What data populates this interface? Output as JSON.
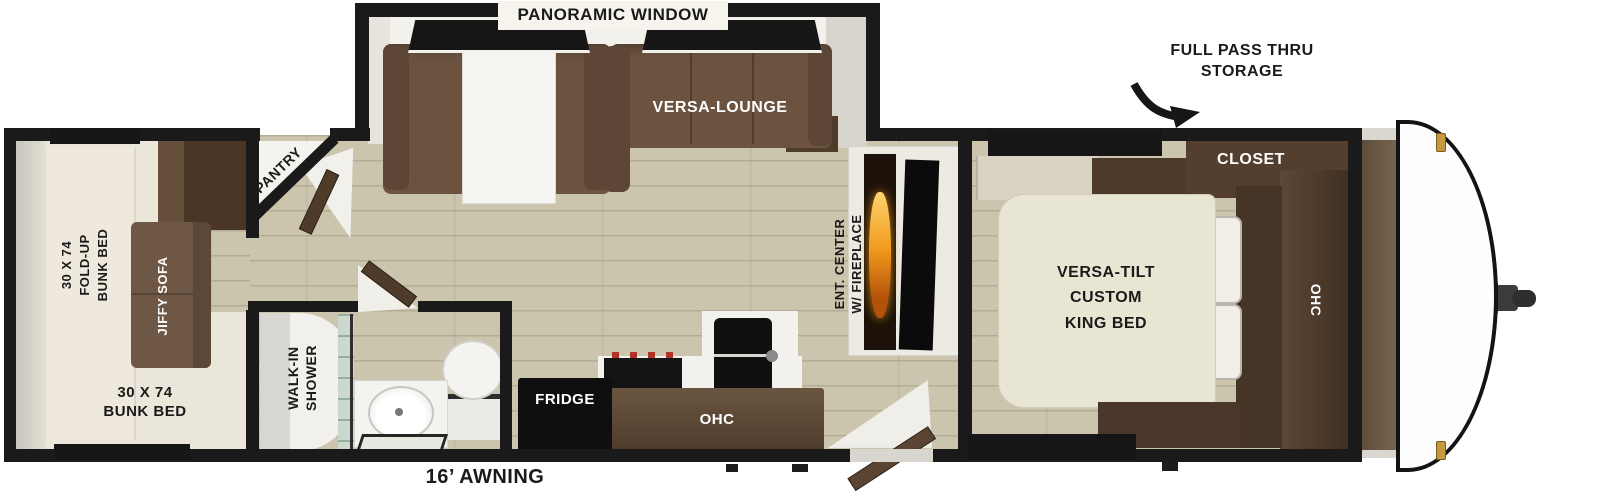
{
  "floorplan": {
    "slideout": {
      "window_label": "PANORAMIC WINDOW",
      "lounge_label": "VERSA-LOUNGE"
    },
    "bunk_room": {
      "foldup_bunk_label": "30 X 74\nFOLD-UP\nBUNK BED",
      "jiffy_sofa_label": "JIFFY SOFA",
      "bunk_bed_label": "30 X 74\nBUNK BED"
    },
    "pantry": {
      "label": "PANTRY"
    },
    "bathroom": {
      "shower_label": "WALK-IN\nSHOWER"
    },
    "kitchen": {
      "fridge_label": "FRIDGE",
      "ohc_label": "OHC"
    },
    "living": {
      "ent_center_label": "ENT. CENTER\nW/ FIREPLACE"
    },
    "bedroom": {
      "bed_label": "VERSA-TILT\nCUSTOM\nKING BED",
      "closet_label": "CLOSET",
      "ohc_label": "OHC"
    },
    "exterior": {
      "storage_label": "FULL PASS THRU\nSTORAGE",
      "awning_label": "16’ AWNING"
    }
  },
  "palette": {
    "wall": "#1a1a1a",
    "floor_wood": "#cbc5ae",
    "bunk_room_floor": "#eae6d9",
    "sofa_brown": "#6b5340",
    "cabinet_dark_brown": "#4a3627",
    "ohc_brown": "#5d4836",
    "bed_cream": "#e9e5d3",
    "flame_orange": "#f09b1d",
    "clearance_light_gold": "#c59a3e",
    "label_black": "#1a1a1a",
    "label_white": "#ffffff"
  }
}
